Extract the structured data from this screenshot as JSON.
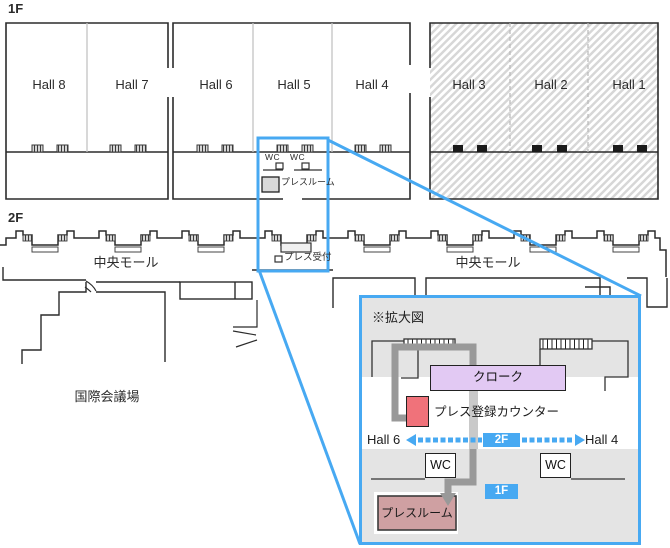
{
  "floor1": {
    "label": "1F",
    "halls": [
      "Hall 8",
      "Hall 7",
      "Hall 6",
      "Hall 5",
      "Hall 4",
      "Hall 3",
      "Hall 2",
      "Hall 1"
    ],
    "wc_left": "WC",
    "wc_right": "WC",
    "pressroom": "プレスルーム"
  },
  "floor2": {
    "label": "2F",
    "mall_left": "中央モール",
    "mall_right": "中央モール",
    "conference": "国際会議場",
    "press_reception": "プレス受付"
  },
  "inset": {
    "title": "※拡大図",
    "cloak": "クローク",
    "press_counter": "プレス登録カウンター",
    "hall_left": "Hall 6",
    "hall_right": "Hall 4",
    "badge_2f": "2F",
    "badge_1f": "1F",
    "wc_left": "WC",
    "wc_right": "WC",
    "pressroom": "プレスルーム"
  },
  "colors": {
    "accent_blue": "#47a9f2",
    "cloak_fill": "#e2c9f3",
    "press_counter_fill": "#f0727a",
    "pressroom_fill": "#cfa0a2",
    "route_gray": "#999999",
    "inset_gray": "#e4e4e4"
  }
}
